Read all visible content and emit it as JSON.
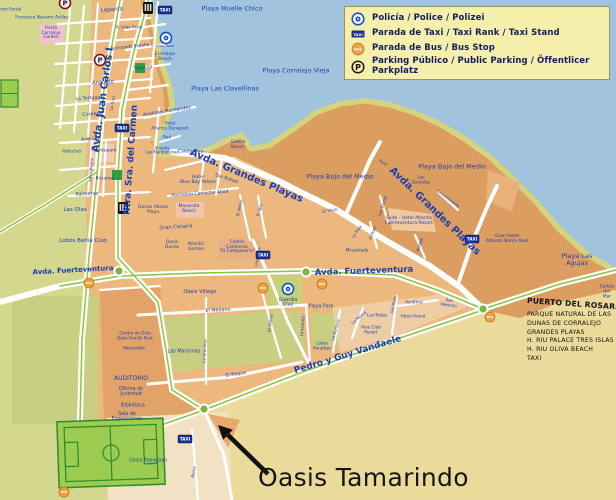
{
  "legend": {
    "items": [
      {
        "icon": "police",
        "label": "Policía / Police / Polizei"
      },
      {
        "icon": "taxi",
        "label": "Parada de Taxi / Taxi Rank / Taxi Stand"
      },
      {
        "icon": "bus",
        "label": "Parada de Bus / Bus Stop"
      },
      {
        "icon": "parking",
        "label": "Parking Público / Public Parking / Öffentlicer Parkplatz"
      }
    ]
  },
  "icon_texts": {
    "taxi": "TAXI",
    "bus": "BUS",
    "parking": "P"
  },
  "callout": {
    "label": "Oasis Tamarindo"
  },
  "exit": {
    "heading": "PUERTO DEL ROSARIO",
    "items": [
      "PARQUE NATURAL DE LAS",
      "DUNAS DE CORRALEJO",
      "GRANDES PLAYAS",
      "H. RIU PALACE TRES ISLAS",
      "H. RIU OLIVA BEACH",
      "TAXI"
    ]
  },
  "colors": {
    "ocean": "#a2c3de",
    "beach": "#d5d47d",
    "dune": "#db9d60",
    "town": "#ecb87e",
    "field": "#d3d88e",
    "park": "#c9cf80",
    "road": "#ffffff",
    "median": "#8cc43c",
    "label_navy": "#1d3fae"
  },
  "map_labels": [
    {
      "t": "Playa Muelle Chico",
      "x": 232,
      "y": 9,
      "s": 6.5
    },
    {
      "t": "Playa Las Clavellinas",
      "x": 225,
      "y": 89,
      "s": 6.5
    },
    {
      "t": "Playa Corralejo Vieja",
      "x": 296,
      "y": 71,
      "s": 6.5
    },
    {
      "t": "Playa Bajo del Medio",
      "x": 340,
      "y": 177,
      "s": 6.5
    },
    {
      "t": "Playa Bajo del Medio",
      "x": 452,
      "y": 167,
      "s": 6.5
    },
    {
      "t": "Playa Las Agujas",
      "x": 577,
      "y": 260,
      "s": 6.5
    },
    {
      "t": "Caleta\ndel Mar",
      "x": 607,
      "y": 293,
      "s": 4.5
    },
    {
      "t": "Avda. Juan Carlos I",
      "x": 104,
      "y": 100,
      "r": -82,
      "s": 10,
      "b": 1
    },
    {
      "t": "Ntra. Sra. del Carmen",
      "x": 132,
      "y": 160,
      "r": -86,
      "s": 9,
      "b": 1
    },
    {
      "t": "Avda. Grandes Playas",
      "x": 246,
      "y": 177,
      "r": 23,
      "s": 10,
      "b": 1
    },
    {
      "t": "Avda. Grandes Playas",
      "x": 434,
      "y": 212,
      "r": 44,
      "s": 10,
      "b": 1
    },
    {
      "t": "Avda. Fuerteventura",
      "x": 73,
      "y": 271,
      "r": -3,
      "s": 7,
      "b": 1
    },
    {
      "t": "Avda. Fuerteventura",
      "x": 364,
      "y": 272,
      "r": -2,
      "s": 8.5,
      "b": 1
    },
    {
      "t": "Pedro y Guy Vandaele",
      "x": 348,
      "y": 356,
      "r": -17,
      "s": 9,
      "b": 1
    },
    {
      "t": "Lepanto",
      "x": 112,
      "y": 11,
      "r": -4,
      "s": 5.5
    },
    {
      "t": "Francisco Navarro Artiles",
      "x": 42,
      "y": 19,
      "s": 4.3
    },
    {
      "t": "Fiesta\nCorralejo\nGarden",
      "x": 51,
      "y": 33,
      "s": 4.2
    },
    {
      "t": "Recinto Ferial",
      "x": 6,
      "y": 11,
      "s": 4.5
    },
    {
      "t": "A. Islas Feral",
      "x": 129,
      "y": 28,
      "s": 4.2
    },
    {
      "t": "Acorazado España",
      "x": 130,
      "y": 47,
      "r": -6,
      "s": 4.2
    },
    {
      "t": "Churruca",
      "x": 143,
      "y": 68,
      "r": -4,
      "s": 4.2
    },
    {
      "t": "L. Islas Rock",
      "x": 163,
      "y": 46,
      "s": 3.8
    },
    {
      "t": "Corralejo\nBeach",
      "x": 165,
      "y": 58,
      "s": 4.5
    },
    {
      "t": "Anzuelo",
      "x": 103,
      "y": 84,
      "r": -4,
      "s": 5.5
    },
    {
      "t": "La Tortuga",
      "x": 88,
      "y": 99,
      "r": -4,
      "s": 4.8
    },
    {
      "t": "La Cruz",
      "x": 113,
      "y": 103,
      "r": -80,
      "s": 4
    },
    {
      "t": "Corbeta",
      "x": 92,
      "y": 115,
      "r": -4,
      "s": 4.8
    },
    {
      "t": "Anguila",
      "x": 90,
      "y": 140,
      "r": -3,
      "s": 4.8
    },
    {
      "t": "Helechos",
      "x": 72,
      "y": 152,
      "s": 4.2
    },
    {
      "t": "Fuentepark",
      "x": 104,
      "y": 152,
      "s": 4.5
    },
    {
      "t": "Agua Marina",
      "x": 91,
      "y": 170,
      "r": -85,
      "s": 3.8
    },
    {
      "t": "Brisamar",
      "x": 105,
      "y": 179,
      "s": 4.2
    },
    {
      "t": "Palmeras",
      "x": 87,
      "y": 195,
      "r": -3,
      "s": 5
    },
    {
      "t": "Las Olas",
      "x": 75,
      "y": 211,
      "s": 5.5
    },
    {
      "t": "Lobos Bahía Club",
      "x": 83,
      "y": 242,
      "s": 5.5
    },
    {
      "t": "Aristides Hernández",
      "x": 167,
      "y": 112,
      "r": -9,
      "s": 4.8
    },
    {
      "t": "Hotel\nAtlantis Dunapark",
      "x": 170,
      "y": 126,
      "s": 4.2
    },
    {
      "t": "Red",
      "x": 167,
      "y": 138,
      "s": 4.2
    },
    {
      "t": "Atlantis\nLas Marquesinas",
      "x": 162,
      "y": 151,
      "s": 4
    },
    {
      "t": "Caleta Playa",
      "x": 192,
      "y": 153,
      "s": 4.5
    },
    {
      "t": "Galera\nBeach",
      "x": 238,
      "y": 146,
      "s": 4.5
    },
    {
      "t": "San Rafael",
      "x": 226,
      "y": 180,
      "r": 18,
      "s": 4.5
    },
    {
      "t": "Hotel\nBlue Bay Palace",
      "x": 198,
      "y": 181,
      "s": 4.5
    },
    {
      "t": "Marcelino Camacho Abad",
      "x": 200,
      "y": 195,
      "r": -4,
      "s": 4.5
    },
    {
      "t": "Maxorata\nBeach",
      "x": 189,
      "y": 210,
      "s": 4.5
    },
    {
      "t": "Dunas Alisios\nPlaya",
      "x": 153,
      "y": 211,
      "s": 4.5
    },
    {
      "t": "Gran Canaria",
      "x": 176,
      "y": 228,
      "r": -4,
      "s": 5
    },
    {
      "t": "Oasis\nDunas",
      "x": 172,
      "y": 246,
      "s": 4.5
    },
    {
      "t": "Atlantic\nGarden",
      "x": 196,
      "y": 248,
      "s": 4.5
    },
    {
      "t": "Centro\nComercial\n\"El Campanario\"",
      "x": 237,
      "y": 248,
      "s": 4.3
    },
    {
      "t": "El Velero",
      "x": 240,
      "y": 208,
      "r": -78,
      "s": 4
    },
    {
      "t": "El Yate",
      "x": 260,
      "y": 210,
      "r": -75,
      "s": 4
    },
    {
      "t": "El Viejo",
      "x": 330,
      "y": 211,
      "r": -10,
      "s": 4.2
    },
    {
      "t": "Faro",
      "x": 383,
      "y": 163,
      "r": 25,
      "s": 4
    },
    {
      "t": "Las\nGaviotas",
      "x": 421,
      "y": 180,
      "s": 4.2
    },
    {
      "t": "Las Dunas",
      "x": 383,
      "y": 206,
      "r": -72,
      "s": 4
    },
    {
      "t": "Suite - Hotel Atlantis\nFuerteventura Resort",
      "x": 409,
      "y": 222,
      "s": 4.5
    },
    {
      "t": "El Pozo",
      "x": 373,
      "y": 233,
      "r": -68,
      "s": 4
    },
    {
      "t": "La Proa",
      "x": 357,
      "y": 232,
      "r": -55,
      "s": 4
    },
    {
      "t": "Mirasolada",
      "x": 357,
      "y": 251,
      "s": 4.2
    },
    {
      "t": "Aulaga",
      "x": 420,
      "y": 245,
      "r": -72,
      "s": 4
    },
    {
      "t": "Guanchinerfe",
      "x": 448,
      "y": 199,
      "r": 38,
      "s": 4
    },
    {
      "t": "Gran Hotel\nAtlantis Bahía Real",
      "x": 507,
      "y": 240,
      "s": 4.5
    },
    {
      "t": "Guardia\nCivil",
      "x": 288,
      "y": 303,
      "s": 4.8
    },
    {
      "t": "Playa Park",
      "x": 321,
      "y": 307,
      "s": 4.8
    },
    {
      "t": "Lanzarote",
      "x": 258,
      "y": 257,
      "r": -80,
      "s": 4
    },
    {
      "t": "Lanzarote",
      "x": 303,
      "y": 326,
      "r": -85,
      "s": 4.2
    },
    {
      "t": "El Hierro",
      "x": 271,
      "y": 323,
      "r": -83,
      "s": 4.2
    },
    {
      "t": "El Médano",
      "x": 218,
      "y": 311,
      "r": -3,
      "s": 4.8
    },
    {
      "t": "Oasis Village",
      "x": 200,
      "y": 293,
      "s": 5.2
    },
    {
      "t": "Las Marismas",
      "x": 184,
      "y": 352,
      "s": 4.8
    },
    {
      "t": "La Graciosa",
      "x": 205,
      "y": 351,
      "r": -87,
      "s": 4
    },
    {
      "t": "El Roque",
      "x": 236,
      "y": 375,
      "r": -8,
      "s": 4.8
    },
    {
      "t": "Lobos\nParadise",
      "x": 322,
      "y": 346,
      "s": 4.2
    },
    {
      "t": "La Gomera",
      "x": 336,
      "y": 330,
      "r": -75,
      "s": 4
    },
    {
      "t": "La Palma",
      "x": 359,
      "y": 318,
      "r": -40,
      "s": 4
    },
    {
      "t": "Las Rotas",
      "x": 377,
      "y": 316,
      "s": 4.2
    },
    {
      "t": "Aloe Club\nResort",
      "x": 371,
      "y": 330,
      "s": 4.2
    },
    {
      "t": "Del Moro",
      "x": 394,
      "y": 305,
      "r": -78,
      "s": 4
    },
    {
      "t": "Verdinas",
      "x": 414,
      "y": 303,
      "s": 4.2
    },
    {
      "t": "Hotel Arena",
      "x": 413,
      "y": 317,
      "s": 4.2
    },
    {
      "t": "San\nValentín",
      "x": 449,
      "y": 303,
      "r": 10,
      "s": 4.2
    },
    {
      "t": "AUDITORIO",
      "x": 131,
      "y": 379,
      "s": 6
    },
    {
      "t": "Oficina de\nJuventud",
      "x": 131,
      "y": 392,
      "s": 4.8
    },
    {
      "t": "Biblioteca",
      "x": 133,
      "y": 406,
      "s": 4.8
    },
    {
      "t": "Sala de\nExposiciones",
      "x": 127,
      "y": 417,
      "s": 4.8
    },
    {
      "t": "Centro de Ocio\nBaku Family Park",
      "x": 135,
      "y": 336,
      "s": 4.2
    },
    {
      "t": "Mercadillo",
      "x": 134,
      "y": 349,
      "s": 4.2
    },
    {
      "t": "Oasis Papagayo",
      "x": 148,
      "y": 461,
      "s": 4.8
    },
    {
      "t": "Barca",
      "x": 194,
      "y": 472,
      "r": -80,
      "s": 4
    }
  ]
}
